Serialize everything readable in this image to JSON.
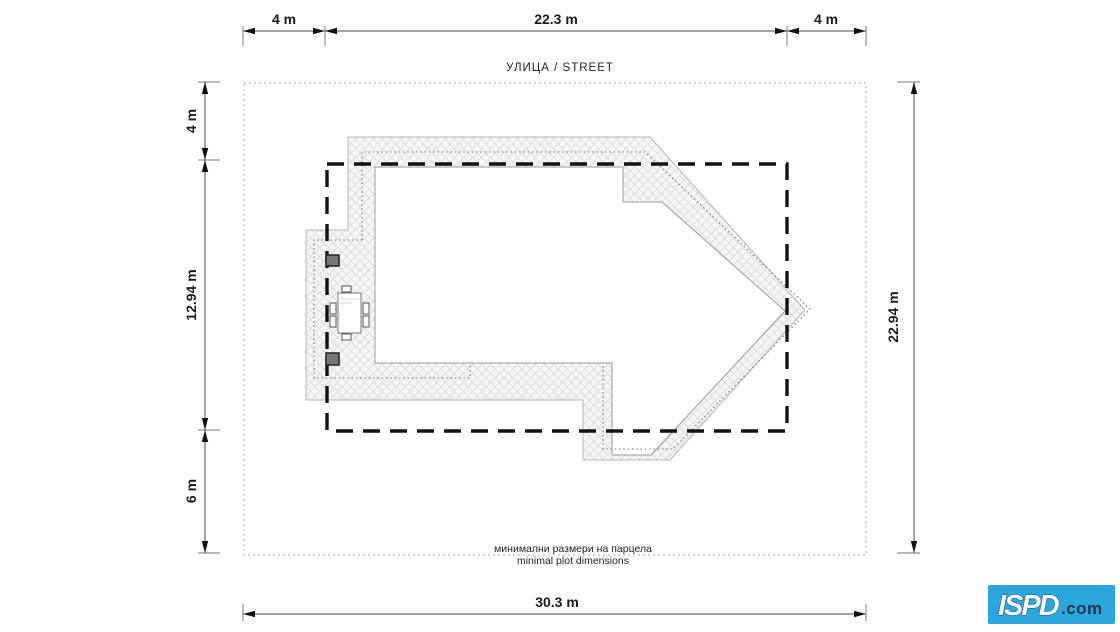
{
  "street_label": "УЛИЦА / STREET",
  "plot_note_line1": "минимални размери на парцела",
  "plot_note_line2": "minimal plot dimensions",
  "dims": {
    "top_left": "4 m",
    "top_center": "22.3 m",
    "top_right": "4 m",
    "left_top": "4 m",
    "left_middle": "12.94 m",
    "left_bottom": "6 m",
    "right_side": "22.94 m",
    "bottom": "30.3 m"
  },
  "logo": {
    "name": "ISPD",
    "suffix": ".com",
    "bg_color": "#2BA7DD",
    "name_color": "#FFFFFF",
    "suffix_color": "#0D3550"
  },
  "colors": {
    "building_envelope_dash": "#121212",
    "roof_edge": "#B8B8B8",
    "hatch_line": "#DCDCDC",
    "hatch_fill": "#F5F5F5",
    "plot_boundary": "#AAAAAA",
    "dimension": "#444444",
    "text": "#1A1A1A"
  }
}
